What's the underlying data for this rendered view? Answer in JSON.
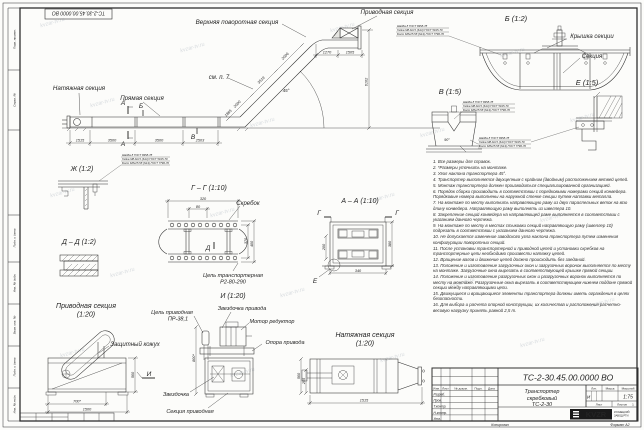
{
  "watermark": "kvzar-tv.ru",
  "main": {
    "label_upper_turn": "Верхняя поворотная секция",
    "label_drive": "Приводная секция",
    "label_tension": "Натяжная секция",
    "label_straight": "Прямая секция",
    "label_see_note": "см. п. 7",
    "angle": "45°",
    "mark_a": "А",
    "mark_b": "Б",
    "mark_v": "В",
    "dim_1515": "1515",
    "dim_3500a": "3500",
    "dim_3500b": "3500",
    "dim_2503": "2503",
    "dim_1865": "1865",
    "dim_2000": "2000",
    "dim_3519": "3519",
    "dim_2006": "2006",
    "dim_1270": "1270",
    "dim_1505": "1505",
    "dim_6102": "6102"
  },
  "fastener": {
    "l1": "Шайба 8 ГОСТ 6958-78",
    "l2": "Гайка М8-6Н.5 (S13) ГОСТ 5915-70",
    "l3": "Болт М8х25.58 (S13) ГОСТ 7796-70"
  },
  "view_b": {
    "title": "Б (1:2)",
    "label_cover": "Крышка секции",
    "label_section": "Секция"
  },
  "view_v": {
    "title": "В (1:5)",
    "dim_angle": "90°"
  },
  "view_e": {
    "title": "Е (1:5)"
  },
  "view_zh": {
    "title": "Ж (1:2)"
  },
  "view_gg": {
    "title": "Г – Г (1:10)",
    "label_scraper": "Скребок",
    "label_chain1": "Цепь транспортерная",
    "label_chain2": "Р2-80-290",
    "mark_d": "Д",
    "dim_320": "320",
    "dim_80": "80",
    "dim_370": "370",
    "dim_400": "400"
  },
  "view_dd": {
    "title": "Д – Д (1:2)"
  },
  "view_aa": {
    "title": "А – А (1:10)",
    "mark_g": "Г",
    "mark_e": "Е",
    "dim_200": "200",
    "dim_380": "380",
    "dim_340": "340"
  },
  "view_drive": {
    "title1": "Приводная секция",
    "title2": "(1:20)",
    "label_cover": "Защитный кожух",
    "mark_i": "И",
    "dim_700": "700*",
    "dim_1500": "1500",
    "dim_560": "560"
  },
  "view_i": {
    "title": "И (1:20)",
    "label_chain1": "Цепь приводная",
    "label_chain2": "ПР-38,1",
    "label_sprocket_drive": "Звездочка привода",
    "label_motor": "Мотор редуктор",
    "label_support": "Опора привода",
    "label_sprocket": "Звездочка",
    "label_section": "Секция приводная",
    "dim_800": "800*"
  },
  "view_tension": {
    "title1": "Натяжная секция",
    "title2": "(1:20)",
    "dim_1515": "1515",
    "dim_560": "560",
    "dim_255": "255"
  },
  "notes": {
    "n1": "1. Все размеры для справок.",
    "n2": "2. *Размеры уточнить на монтаже.",
    "n3": "3. Угол наклона транспортера 45°.",
    "n4": "4. Транспортер выполняется двухцепным с крайним (двойным) расположением ветвей цепей.",
    "n5": "5. Монтаж транспортера должен производиться специализированной организацией.",
    "n6": "6. Порядок сборки производить в соответствии с порядковыми номерами секций конвейера. Порядковые номера выполнены на наружной стенке секции путем наплавки металла.",
    "n7": "7. На монтаже по месту выполнить направляющую раму из двух параллельных веток на всю длину конвейера. Направляющую раму выполнять из швеллера 10.",
    "n8": "8. Закрепление секций конвейера на направляющей раме выполняется в соответствии с указанием данного чертежа.",
    "n9": "9. На монтаже по месту в местах стыковки секций направляющую раму (швеллер 10) подрезать в соответствии с указанием данного чертежа.",
    "n10": "10. Не допускается изменение заводского угла наклона транспортера путем изменения конфигурации поворотных секций.",
    "n11": "11. После установки транспортерной и приводной цепей и установки скребков на транспортерные цепи необходимо произвести натяжку цепей.",
    "n12": "12. Вращение валов и движение цепей должно происходить без заеданий.",
    "n13": "13. Положение и изготовление загрузочных окон и загрузочных воронок выполняется по месту на монтаже. Загрузочные окна вырезать в соответствующей крышке прямой секции.",
    "n14": "14. Положение и изготовление разгрузочных окон и разгрузочных воронок выполняется по месту на монтаже. Разгрузочные окна вырезать в соответствующем нижнем поддоне прямой секции между направляющими цепи.",
    "n15": "15. Движущиеся и вращающиеся элементы транспортера должны иметь ограждения в целях безопасности.",
    "n16": "16. Для выбора и расчета опорной конструкции, их количества и расположения расчетно-весовую нагрузку принять равной 2,5 т."
  },
  "tb": {
    "doc_number": "ТС-2-30.45.00.0000 ВО",
    "name1": "Транспортер",
    "name2": "скребковый",
    "name3": "ТС-2-30",
    "lit_h": "Лит.",
    "mass_h": "Масса",
    "scale_h": "Масштаб",
    "lit": "И",
    "scale": "1:75",
    "sheet_h": "Лист",
    "sheets_h": "Листов",
    "sheets": "1",
    "col_izm": "Изм.",
    "col_list": "Лист",
    "col_doc": "№ докум.",
    "col_podp": "Подп.",
    "col_data": "Дата",
    "r1": "Разраб.",
    "r2": "Пров.",
    "r3": "Т.контр.",
    "r4": "Н.контр.",
    "r5": "Утв.",
    "logo": "KVZR",
    "logo1": "КУЗНЕЦКИЙ",
    "logo2": "ЗАВОД РТИ",
    "copied": "Копировал",
    "format": "Формат А2"
  },
  "frame": {
    "f1": "Перв. примен.",
    "f2": "Справ. №",
    "f3": "Подп. и дата",
    "f4": "Инв. № дубл.",
    "f5": "Взам. инв. №",
    "f6": "Подп. и дата",
    "f7": "Инв. № подл."
  }
}
